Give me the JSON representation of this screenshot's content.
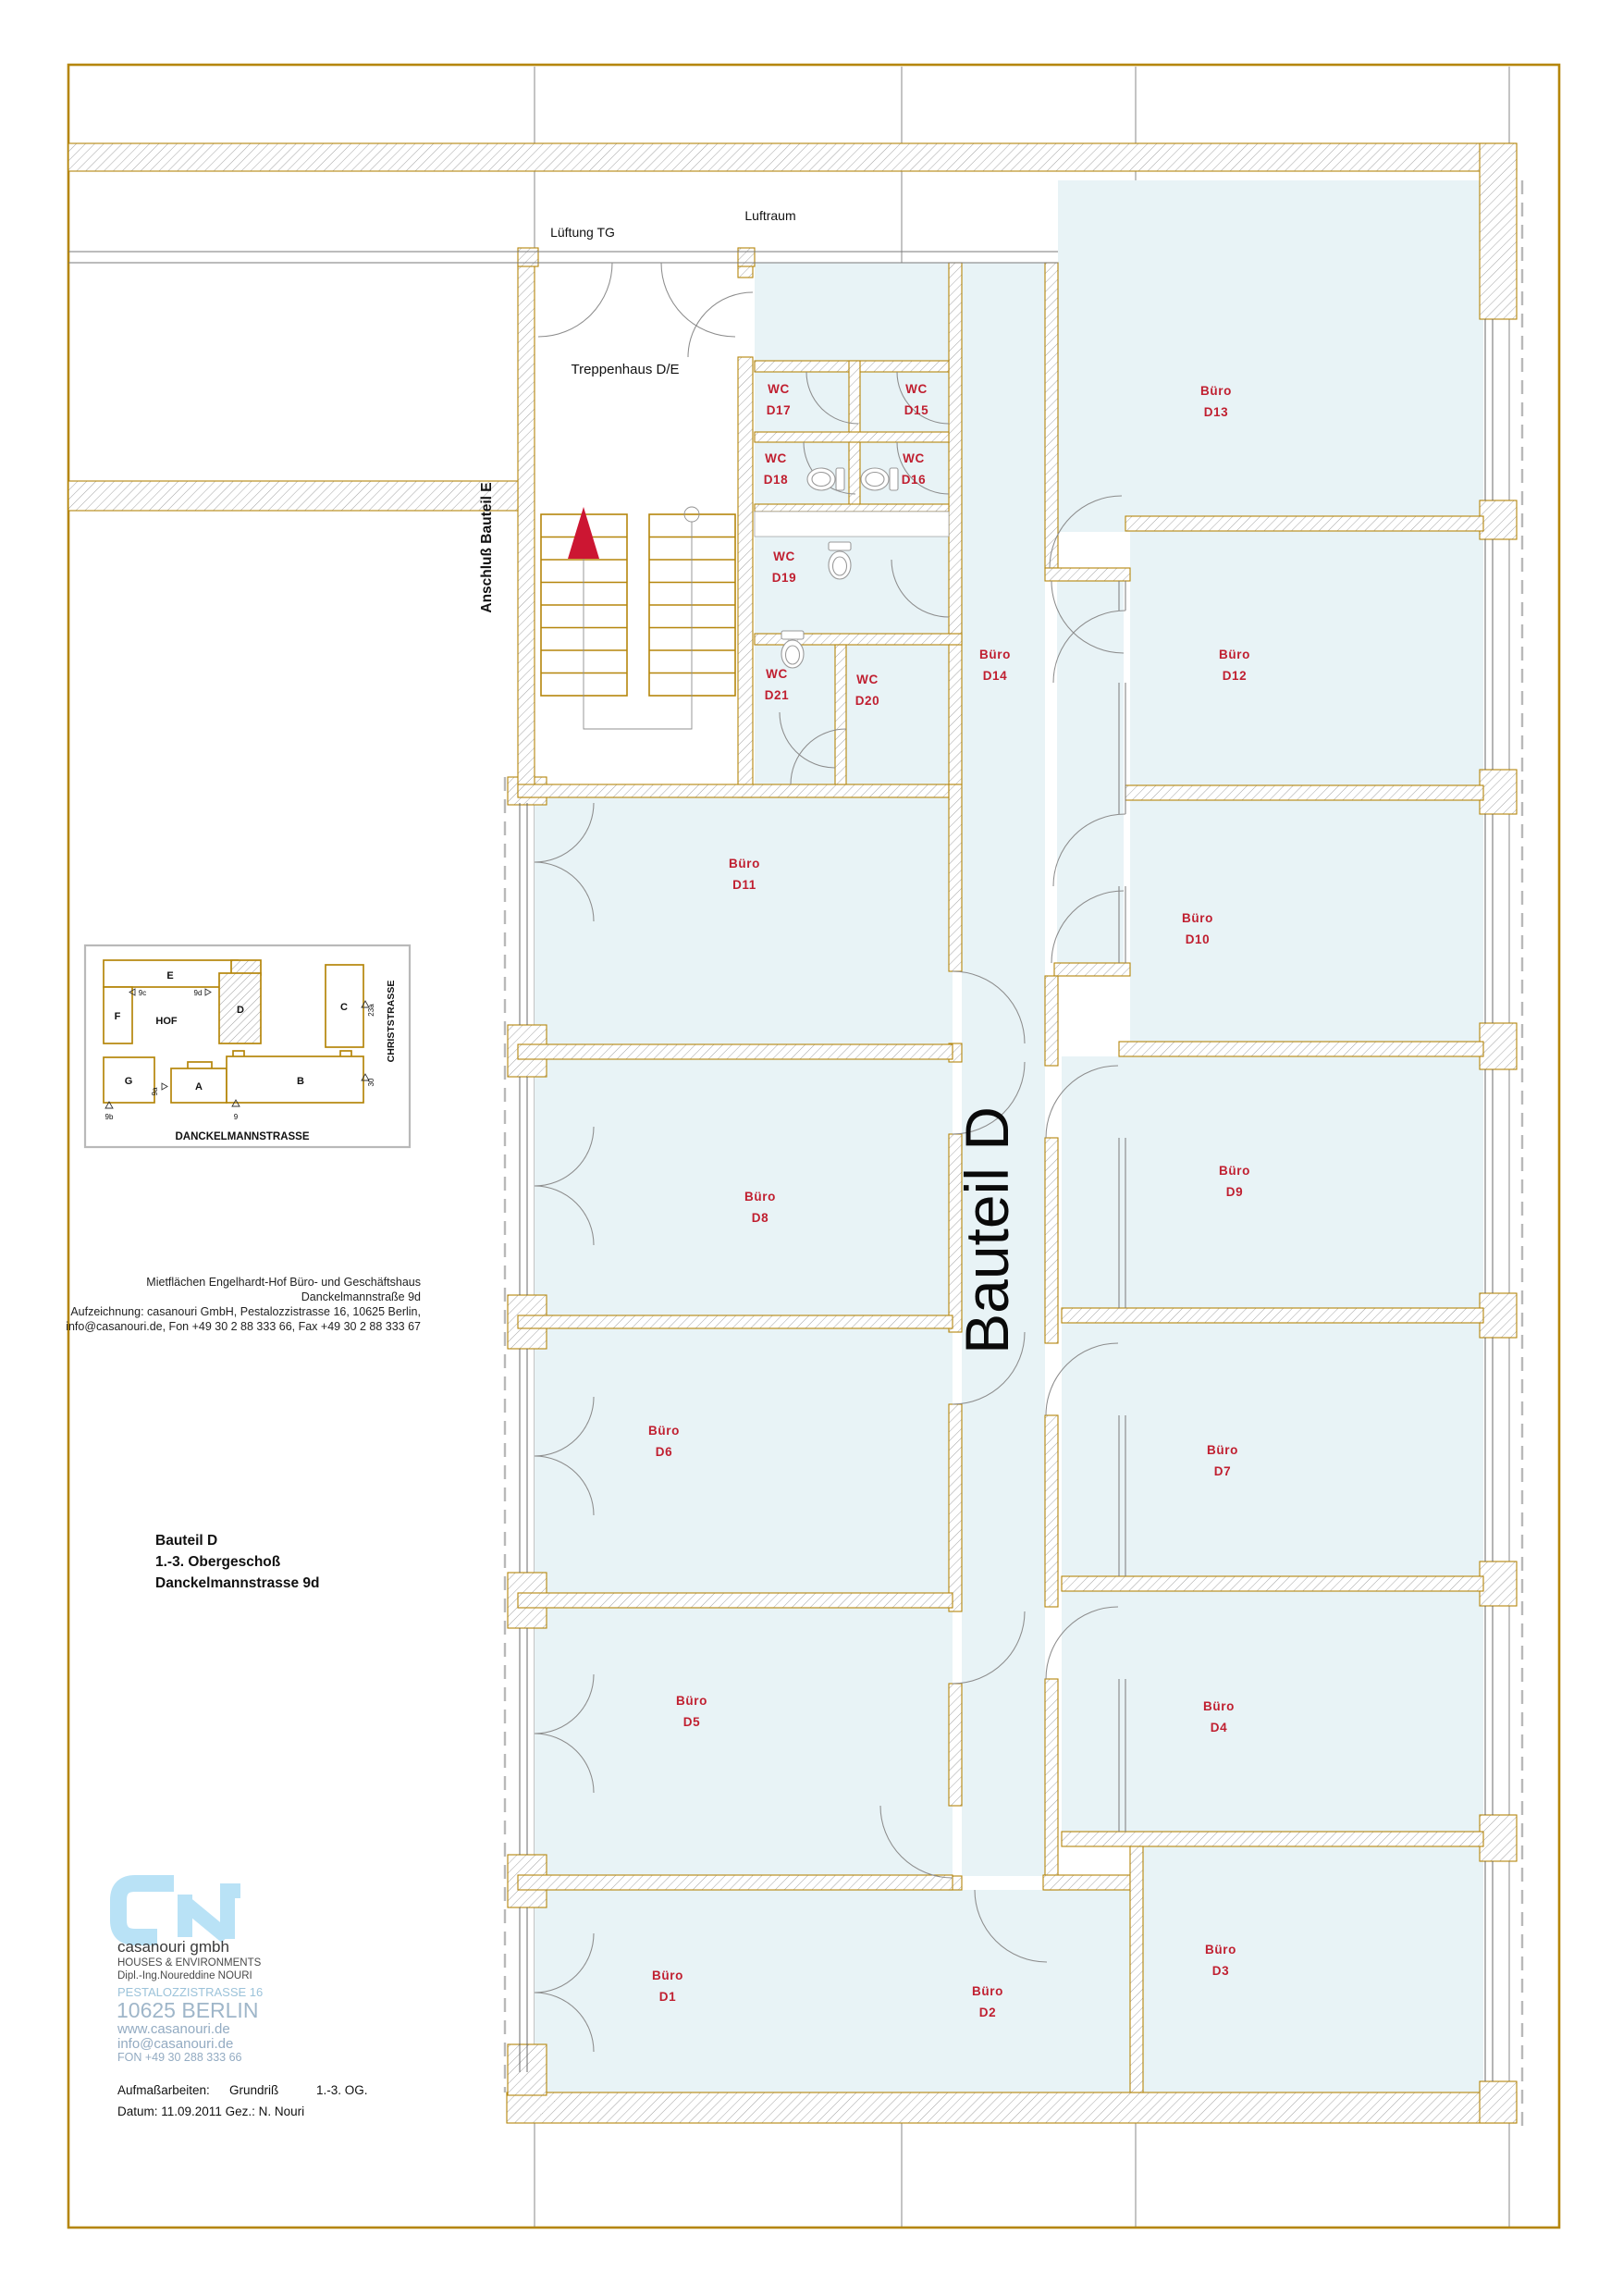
{
  "colors": {
    "wall_gold": "#b5860b",
    "room_fill": "#e8f3f6",
    "label_red": "#c01f30",
    "hatch_gray": "#9a9a9a",
    "arrow_red": "#cc1632",
    "logo_blue": "#b9e2f6",
    "logo_text_blue": "#9fb6c9"
  },
  "annotations": {
    "lueftung": "Lüftung TG",
    "luftraum": "Luftraum",
    "treppenhaus": "Treppenhaus D/E",
    "anschluss": "Anschluß Bauteil E",
    "corridor": "Bauteil D"
  },
  "rooms": [
    {
      "id": "D1",
      "type": "Büro"
    },
    {
      "id": "D2",
      "type": "Büro"
    },
    {
      "id": "D3",
      "type": "Büro"
    },
    {
      "id": "D4",
      "type": "Büro"
    },
    {
      "id": "D5",
      "type": "Büro"
    },
    {
      "id": "D6",
      "type": "Büro"
    },
    {
      "id": "D7",
      "type": "Büro"
    },
    {
      "id": "D8",
      "type": "Büro"
    },
    {
      "id": "D9",
      "type": "Büro"
    },
    {
      "id": "D10",
      "type": "Büro"
    },
    {
      "id": "D11",
      "type": "Büro"
    },
    {
      "id": "D12",
      "type": "Büro"
    },
    {
      "id": "D13",
      "type": "Büro"
    },
    {
      "id": "D14",
      "type": "Büro"
    },
    {
      "id": "D15",
      "type": "WC"
    },
    {
      "id": "D16",
      "type": "WC"
    },
    {
      "id": "D17",
      "type": "WC"
    },
    {
      "id": "D18",
      "type": "WC"
    },
    {
      "id": "D19",
      "type": "WC"
    },
    {
      "id": "D20",
      "type": "WC"
    },
    {
      "id": "D21",
      "type": "WC"
    }
  ],
  "key_plan": {
    "hof": "HOF",
    "street_bottom": "DANCKELMANNSTRASSE",
    "street_right": "CHRISTSTRASSE",
    "labels": {
      "a": "A",
      "b": "B",
      "c": "C",
      "d": "D",
      "e": "E",
      "f": "F",
      "g": "G"
    },
    "markers": {
      "m9": "9",
      "m9a": "9a",
      "m9b": "9b",
      "m9c": "9c",
      "m9d": "9d",
      "m23a": "23a",
      "m30": "30"
    }
  },
  "title_block": {
    "address_lines": [
      "Mietflächen Engelhardt-Hof Büro- und Geschäftshaus",
      "Danckelmannstraße 9d",
      "Aufzeichnung: casanouri GmbH, Pestalozzistrasse 16, 10625 Berlin,",
      "info@casanouri.de, Fon +49 30 2 88 333 66, Fax +49 30 2 88 333 67"
    ],
    "heading_lines": [
      "Bauteil D",
      "1.-3. Obergeschoß",
      "Danckelmannstrasse 9d"
    ],
    "company": {
      "name": "casanouri gmbh",
      "tagline": "HOUSES & ENVIRONMENTS",
      "owner": "Dipl.-Ing.Noureddine NOURI",
      "street": "PESTALOZZISTRASSE 16",
      "city": "10625 BERLIN",
      "web": "www.casanouri.de",
      "email": "info@casanouri.de",
      "phone": "FON +49 30 288 333 66"
    },
    "footer": {
      "label": "Aufmaßarbeiten:",
      "value1": "Grundriß",
      "value2": "1.-3. OG.",
      "line2": "Datum: 11.09.2011 Gez.: N. Nouri"
    }
  }
}
